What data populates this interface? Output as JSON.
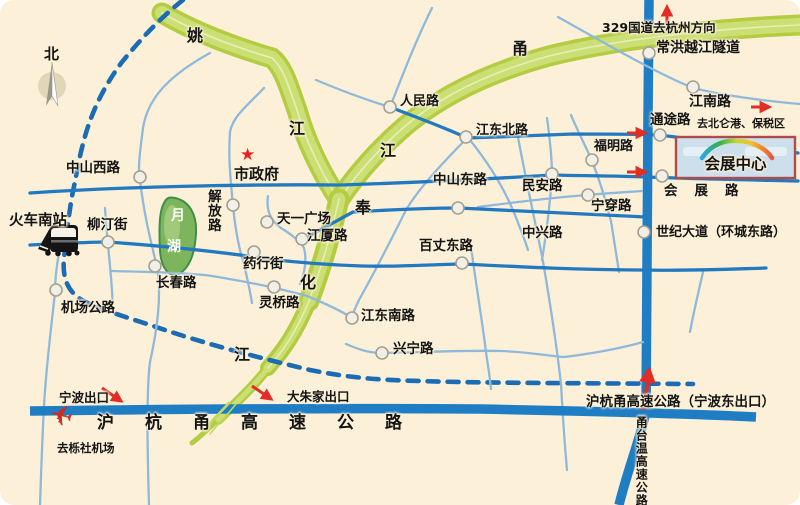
{
  "title": "宁波会展中心交通示意图",
  "labels": {
    "north": "北",
    "river_yao_1": "姚",
    "river_yao_2": "江",
    "river_yong_1": "甬",
    "river_yong_2": "江",
    "river_fenghua_1": "奉",
    "river_fenghua_2": "化",
    "river_fenghua_3": "江",
    "g329": "329国道去杭州方向",
    "changhong_tunnel": "常洪越江隧道",
    "renmin_rd": "人民路",
    "jiangnan_rd": "江南路",
    "tongtu_rd": "通途路",
    "to_beilun": "去北仑港、保税区",
    "jiangdongbei_rd": "江东北路",
    "fuming_rd": "福明路",
    "zhongshanxi_rd": "中山西路",
    "city_hall": "市政府",
    "zhongshandong_rd": "中山东路",
    "minan_rd": "民安路",
    "exhibition_center": "会展中心",
    "huizhan_rd": "会展路",
    "ningchuan_rd": "宁穿路",
    "shiji_avenue": "世纪大道（环城东路）",
    "jiefang_rd": "解放路",
    "tianyi_square": "天一广场",
    "jiangxia_rd": "江厦路",
    "baizhangdong_rd": "百丈东路",
    "zhongxing_rd": "中兴路",
    "liuting_st": "柳汀街",
    "south_railway_station": "火车南站",
    "moon_lake_1": "月",
    "moon_lake_2": "湖",
    "yaohang_st": "药行街",
    "changchun_rd": "长春路",
    "jichang_hwy": "机场公路",
    "lingqiao_rd": "灵桥路",
    "jiangdongnan_rd": "江东南路",
    "xingning_rd": "兴宁路",
    "ningbo_exit": "宁波出口",
    "dazhujia_exit": "大朱家出口",
    "huhangyong_expwy": "沪杭甬高速公路",
    "huhangyong_east_exit": "沪杭甬高速公路（宁波东出口）",
    "yongtaiwen_expwy": "甬台温高速公路",
    "to_lishe_airport": "去栎社机场"
  },
  "icons": {
    "city_hall_star": "★",
    "airplane": "✈"
  },
  "colors": {
    "background": "#fcf1d8",
    "road": "#2e85c5",
    "road_light": "#8fb9da",
    "highway": "#1f7dc4",
    "boundary_dash": "#1b6cb5",
    "river": "#bfd64f",
    "lake": "#7db55c",
    "accent_red": "#e12d23",
    "exhibition_box_fill": "#ccdfeb",
    "exhibition_box_border": "#b14a4a",
    "text": "#141414"
  }
}
